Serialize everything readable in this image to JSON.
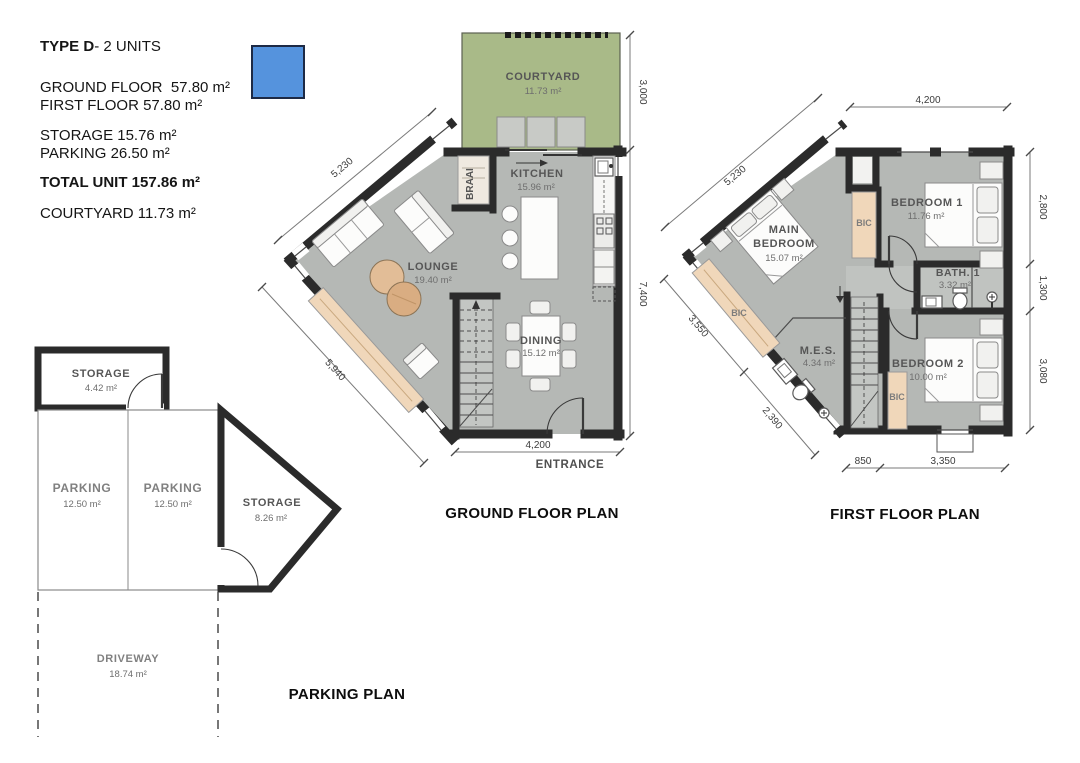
{
  "legend": {
    "title_bold": "TYPE D",
    "title_rest": "- 2 UNITS",
    "ground_floor": "GROUND FLOOR  57.80 m²",
    "first_floor": "FIRST FLOOR 57.80 m²",
    "storage": "STORAGE 15.76 m²",
    "parking": "PARKING 26.50 m²",
    "total": "TOTAL UNIT 157.86 m²",
    "courtyard": "COURTYARD 11.73 m²",
    "swatch_color": "#5593DD"
  },
  "ground_floor": {
    "title": "GROUND FLOOR PLAN",
    "entrance_label": "ENTRANCE",
    "rooms": {
      "courtyard": {
        "name": "COURTYARD",
        "area": "11.73 m²"
      },
      "kitchen": {
        "name": "KITCHEN",
        "area": "15.96 m²"
      },
      "lounge": {
        "name": "LOUNGE",
        "area": "19.40 m²"
      },
      "dining": {
        "name": "DINING",
        "area": "15.12 m²"
      },
      "braai": {
        "name": "BRAAI"
      }
    },
    "dims": {
      "courtyard_right": "3,000",
      "right": "7,400",
      "upper_left": "5,230",
      "lower_left": "5,940",
      "bottom": "4,200"
    }
  },
  "first_floor": {
    "title": "FIRST FLOOR PLAN",
    "rooms": {
      "main_bedroom": {
        "name_line1": "MAIN",
        "name_line2": "BEDROOM",
        "area": "15.07 m²"
      },
      "bedroom1": {
        "name": "BEDROOM 1",
        "area": "11.76 m²"
      },
      "bedroom2": {
        "name": "BEDROOM 2",
        "area": "10.00 m²"
      },
      "bath1": {
        "name": "BATH. 1",
        "area": "3.32 m²"
      },
      "mes": {
        "name": "M.E.S.",
        "area": "4.34 m²"
      },
      "bic_left": {
        "name": "BIC"
      },
      "bic_top": {
        "name": "BIC"
      },
      "bic_bottom": {
        "name": "BIC"
      }
    },
    "dims": {
      "top": "4,200",
      "upper_left": "5,230",
      "left": "3,550",
      "lower_left": "2,390",
      "right_top": "2,800",
      "right_mid": "1,300",
      "right_bottom": "3,080",
      "bottom_left": "850",
      "bottom_right": "3,350"
    }
  },
  "parking": {
    "title": "PARKING PLAN",
    "rooms": {
      "storage_top": {
        "name": "STORAGE",
        "area": "4.42 m²"
      },
      "parking_left": {
        "name": "PARKING",
        "area": "12.50 m²"
      },
      "parking_right": {
        "name": "PARKING",
        "area": "12.50 m²"
      },
      "storage_right": {
        "name": "STORAGE",
        "area": "8.26 m²"
      },
      "driveway": {
        "name": "DRIVEWAY",
        "area": "18.74 m²"
      }
    }
  }
}
